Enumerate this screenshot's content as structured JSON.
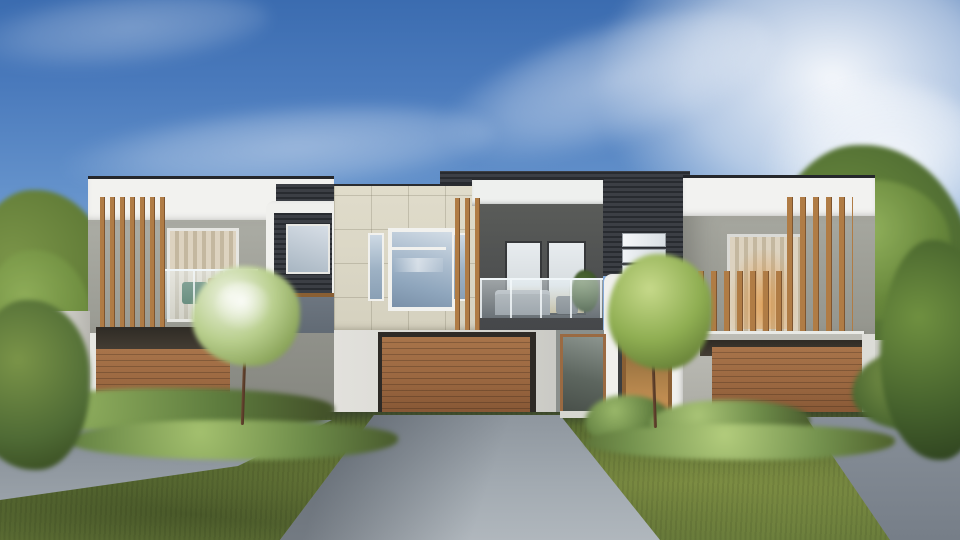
{
  "scene": {
    "type": "architectural exterior render",
    "description": "Front elevation of a modern two-storey multi-unit townhouse (duplex) with three timber garage doors, vertical timber batten balcony screens, dark face-brick feature piers, white parapet fascias, landscaped hedges and lawn, concrete driveways, flanked by green trees under a blue sky with wispy clouds",
    "time_of_day": "daytime, sunny",
    "sky": {
      "top_color": "#3b6cb0",
      "horizon_color": "#cbdbee",
      "cloud_color": "#ffffff",
      "cloud_position": "large bright cloud mass upper right, thin wisps centre-left"
    },
    "building": {
      "storeys": 2,
      "garage_count": 3,
      "left_unit": {
        "fascia_color": "#f2f2ef",
        "wall_color": "#a9aaa2",
        "batten_screen_color": "#a97843",
        "balcony": "glass balustrade with interior seating and beige vertical blinds",
        "garage_door_color": "#9a6a42"
      },
      "center_unit": {
        "panel_color": "#dcd8c7",
        "feature_window": "white framed picture window with two narrow sidelights, blue-grey reflective glass",
        "recessed_balcony_wall": "#55575a",
        "balcony_furniture": "grey outdoor sofa, small table, potted plant",
        "garage_door_color": "#9f6b43"
      },
      "right_unit": {
        "fascia_color": "#f2f2f0",
        "wall_color": "#a3a49c",
        "window": "warm lit window with beige vertical blinds",
        "batten_screen": "tall and short vertical timber battens",
        "garage_door_color": "#9a6a42"
      },
      "accents": {
        "dark_brick": "#2f3238",
        "brick_pier_windows": "three white horizontal slot windows",
        "entry_portals": "white wrap-around portal frames",
        "entry_door_color": "#8a5f33"
      }
    },
    "landscape": {
      "lawn_color": "#5d7034",
      "hedge_color": "#5e7c3e",
      "driveway_color": "#9aa2a9",
      "tree_dark": "#4a6630",
      "tree_light": "#7a9448",
      "accent_shrub": "#8a5a3a",
      "features": [
        "blossoming ornamental tree left of centre",
        "small green tree right of centre",
        "box hedge rows along building base",
        "dense trees on both sides",
        "low white side fence at left"
      ]
    }
  },
  "palette": {
    "sky_blue": "#4a7abc",
    "white_render": "#f2f2ef",
    "grey_render": "#a9aaa2",
    "cream_panel": "#dcd8c7",
    "dark_brick": "#2f3238",
    "timber": "#a97843",
    "garage_wood": "#9a6a42",
    "glass": "#9fb4c6",
    "lawn": "#5d7034",
    "hedge": "#5e7c3e",
    "driveway": "#9aa2a9",
    "warm_interior": "#c28e52"
  }
}
